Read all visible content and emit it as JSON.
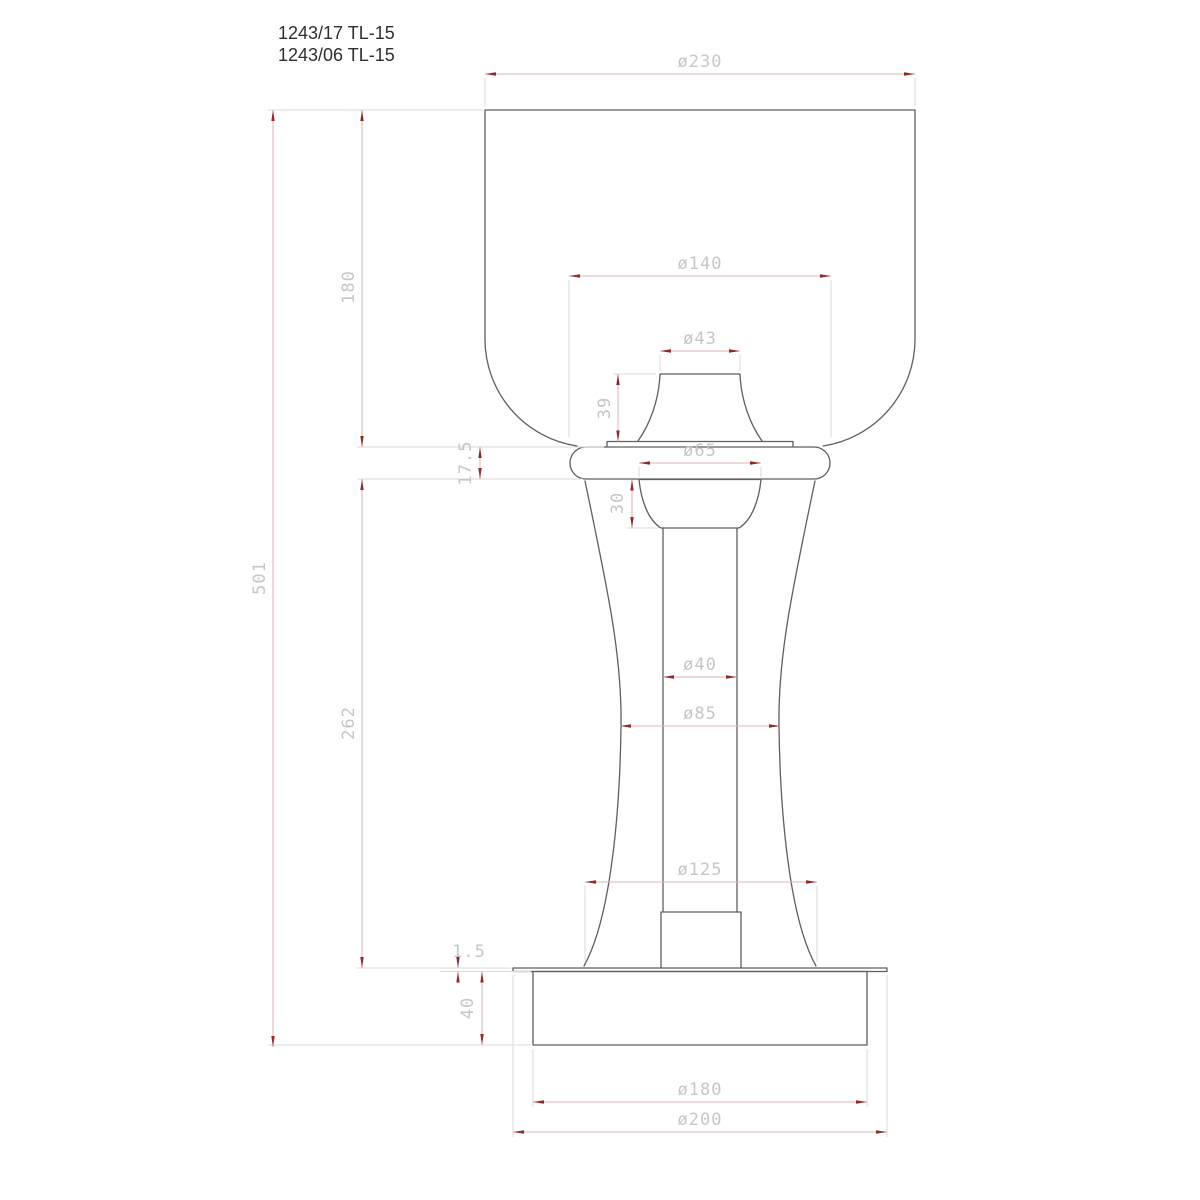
{
  "title": {
    "line1": "1243/17 TL-15",
    "line2": "1243/06 TL-15"
  },
  "dimensions": {
    "shade_outer_diameter": "ø230",
    "shade_height": "180",
    "shade_opening_diameter": "ø140",
    "socket_diameter": "ø43",
    "socket_height": "39",
    "collar_height": "17.5",
    "neck_diameter": "ø65",
    "capital_height": "30",
    "overall_height": "501",
    "column_height": "262",
    "stem_diameter": "ø40",
    "waist_diameter": "ø85",
    "foot_diameter": "ø125",
    "base_plate_thickness": "1.5",
    "base_height": "40",
    "base_diameter": "ø180",
    "base_plate_diameter": "ø200"
  },
  "colors": {
    "object_line": "#5f5f5f",
    "dimension_line": "#ddb3b3",
    "extension_line": "#d8d8d8",
    "arrowhead": "#8e2a2a",
    "dimension_text": "#c6c6c6",
    "title_text": "#2f2f2f",
    "background": "#ffffff"
  }
}
